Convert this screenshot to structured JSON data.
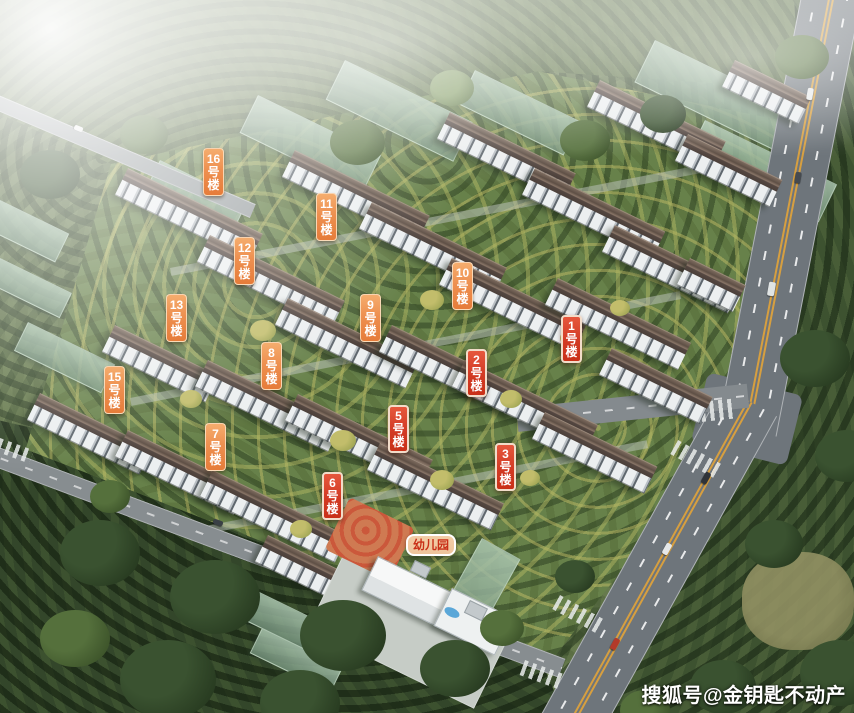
{
  "scene": {
    "description": "Aerial 3D rendering of a residential community site plan with numbered building tags"
  },
  "buildings": [
    {
      "label": "1号楼",
      "x": 561,
      "y": 315,
      "style": "red"
    },
    {
      "label": "2号楼",
      "x": 466,
      "y": 349,
      "style": "red"
    },
    {
      "label": "3号楼",
      "x": 495,
      "y": 443,
      "style": "red"
    },
    {
      "label": "5号楼",
      "x": 388,
      "y": 405,
      "style": "red"
    },
    {
      "label": "6号楼",
      "x": 322,
      "y": 472,
      "style": "red"
    },
    {
      "label": "7号楼",
      "x": 205,
      "y": 423,
      "style": "orange"
    },
    {
      "label": "8号楼",
      "x": 261,
      "y": 342,
      "style": "orange"
    },
    {
      "label": "9号楼",
      "x": 360,
      "y": 294,
      "style": "orange"
    },
    {
      "label": "10号楼",
      "x": 452,
      "y": 262,
      "style": "orange"
    },
    {
      "label": "11号楼",
      "x": 316,
      "y": 193,
      "style": "orange"
    },
    {
      "label": "12号楼",
      "x": 234,
      "y": 237,
      "style": "orange"
    },
    {
      "label": "13号楼",
      "x": 166,
      "y": 294,
      "style": "orange"
    },
    {
      "label": "15号楼",
      "x": 104,
      "y": 366,
      "style": "orange"
    },
    {
      "label": "16号楼",
      "x": 203,
      "y": 148,
      "style": "orange"
    }
  ],
  "kindergarten": {
    "label": "幼儿园",
    "x": 406,
    "y": 534
  },
  "watermark": {
    "text": "搜狐号@金钥匙不动产"
  },
  "colors": {
    "tag_orange_top": "#f5ad6e",
    "tag_orange_bottom": "#e67c3a",
    "tag_red_top": "#e6573d",
    "tag_red_bottom": "#c93018",
    "tag_red_border": "#f2dcc9",
    "tag_text": "#ffffff",
    "kindergarten_bg": "#eec49c",
    "kindergarten_text": "#c93018",
    "watermark_text": "#ffffff"
  }
}
